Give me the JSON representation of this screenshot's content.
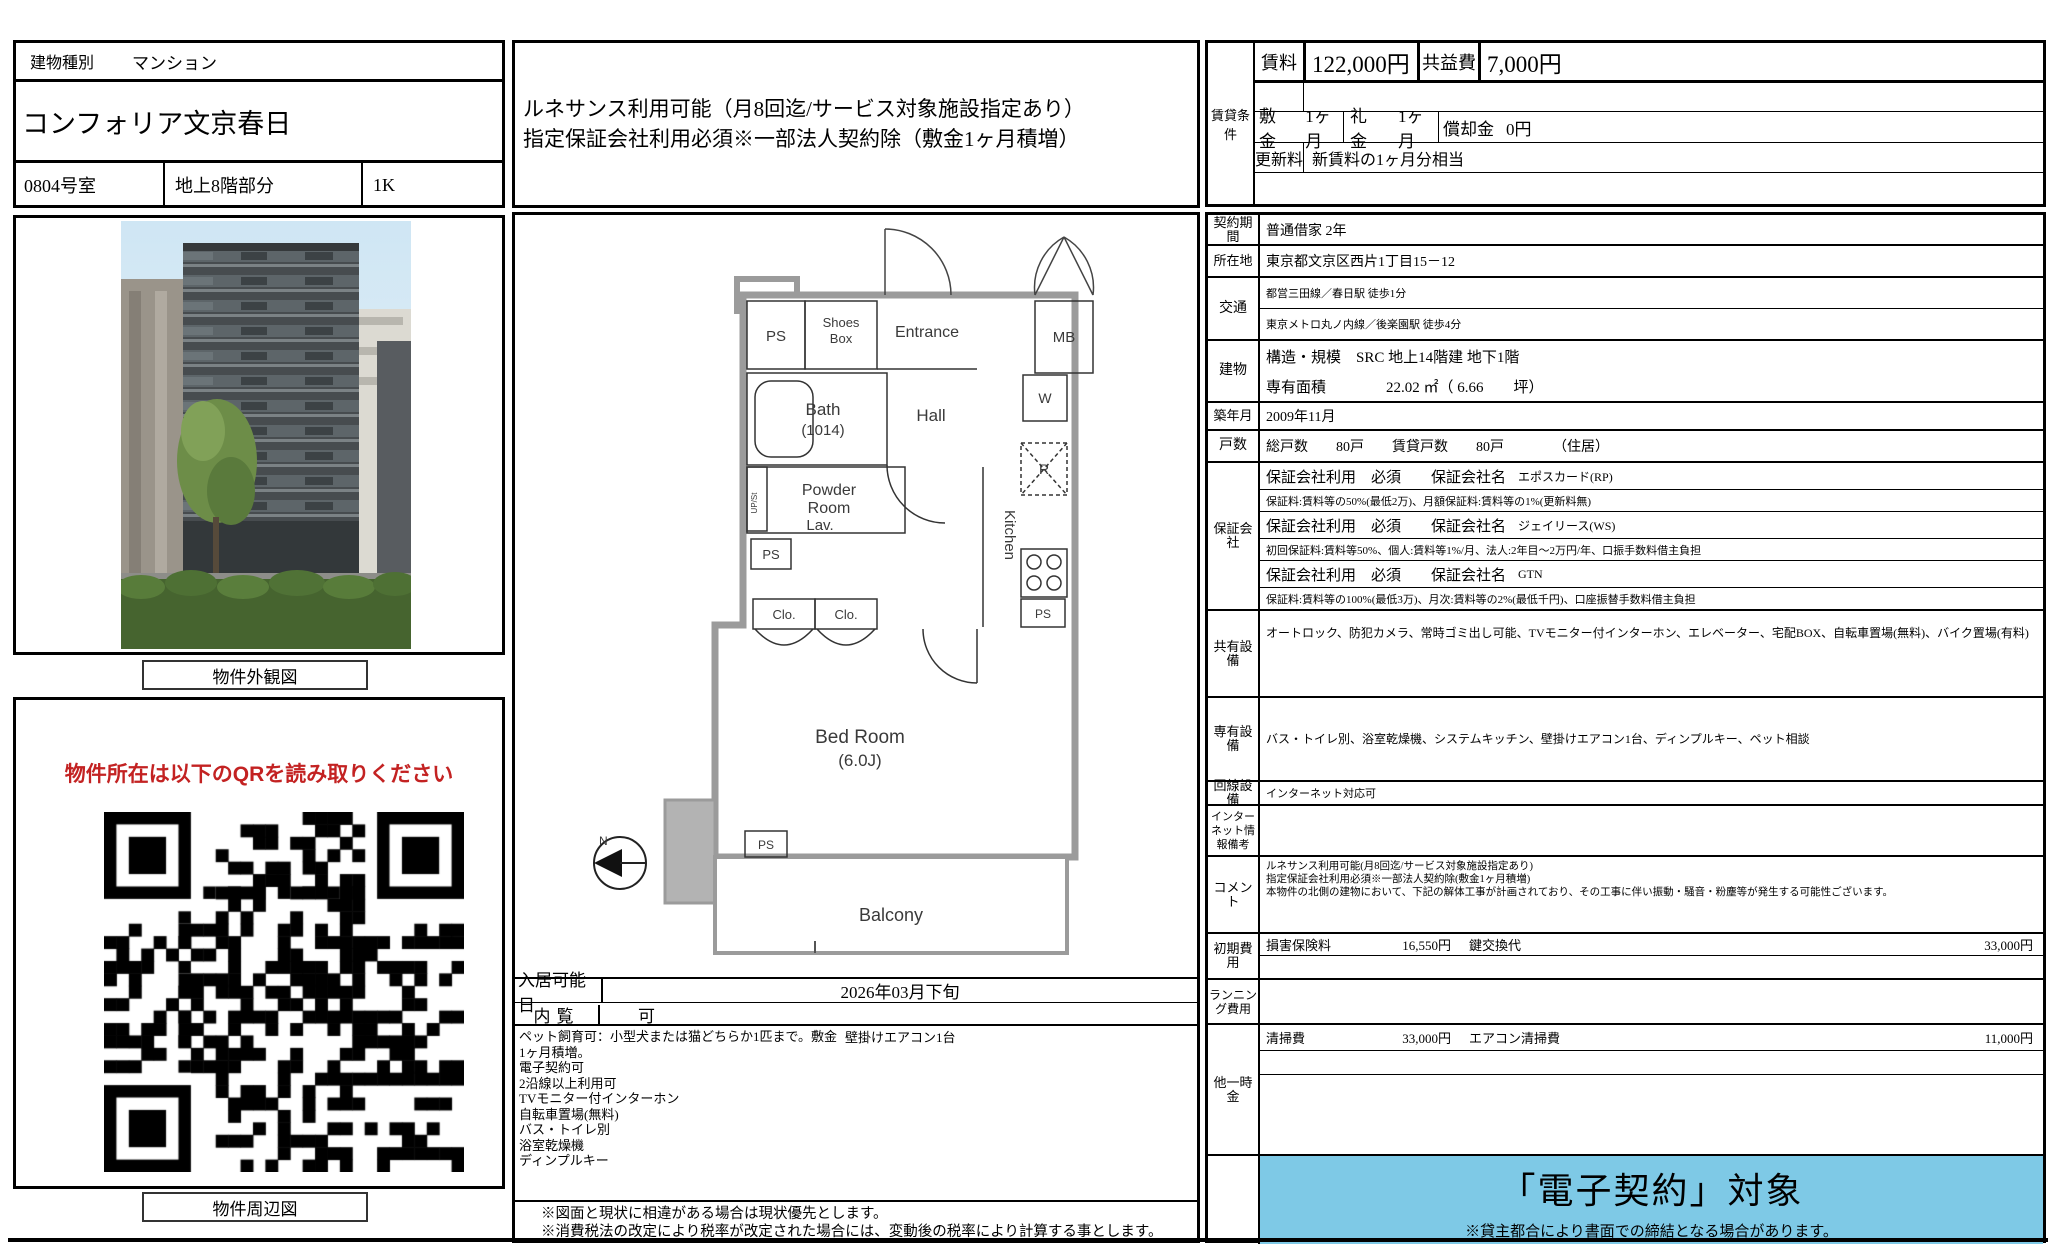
{
  "header": {
    "building_type_label": "建物種別",
    "building_type_value": "マンション",
    "property_name": "コンフォリア文京春日",
    "room_no": "0804号室",
    "floor": "地上8階部分",
    "layout": "1K"
  },
  "top_note": {
    "line1": "ルネサンス利用可能（月8回迄/サービス対象施設指定あり）",
    "line2": "指定保証会社利用必須※一部法人契約除（敷金1ヶ月積増）"
  },
  "photo": {
    "caption": "物件外観図"
  },
  "qr": {
    "heading": "物件所在は以下のQRを読み取りください",
    "heading_color": "#c32222",
    "caption": "物件周辺図"
  },
  "rent_box": {
    "group_label": "賃貸条件",
    "rent_label": "賃料",
    "rent_value": "122,000円",
    "fee_label": "共益費",
    "fee_value": "7,000円",
    "deposit_label": "敷金",
    "deposit_value": "1ヶ月",
    "key_label": "礼金",
    "key_value": "1ヶ月",
    "amort_label": "償却金",
    "amort_value": "0円",
    "renewal_label": "更新料",
    "renewal_value": "新賃料の1ヶ月分相当"
  },
  "details": {
    "contract": {
      "label": "契約期間",
      "value": "普通借家 2年"
    },
    "address": {
      "label": "所在地",
      "value": "東京都文京区西片1丁目15－12"
    },
    "access": {
      "label": "交通",
      "lines": [
        "都営三田線／春日駅 徒歩1分",
        "東京メトロ丸ノ内線／後楽園駅 徒歩4分"
      ]
    },
    "building": {
      "label": "建物",
      "structure": "構造・規模　SRC 地上14階建 地下1階",
      "area": "専有面積　　　　22.02 ㎡（ 6.66　　坪）"
    },
    "built": {
      "label": "築年月",
      "value": "2009年11月"
    },
    "units": {
      "label": "戸数",
      "value": "総戸数　　80戸　　賃貸戸数　　80戸　　　　（住居）"
    },
    "guarantor": {
      "label": "保証会社",
      "rows": [
        {
          "main": "保証会社利用　必須　　保証会社名",
          "name": "エポスカード(RP)"
        },
        {
          "sub": "保証料:賃料等の50%(最低2万)、月額保証料:賃料等の1%(更新料無)"
        },
        {
          "main": "保証会社利用　必須　　保証会社名",
          "name": "ジェイリース(WS)"
        },
        {
          "sub": "初回保証料:賃料等50%、個人:賃料等1%/月、法人:2年目～2万円/年、口振手数料借主負担"
        },
        {
          "main": "保証会社利用　必須　　保証会社名",
          "name": "GTN"
        },
        {
          "sub": "保証料:賃料等の100%(最低3万)、月次:賃料等の2%(最低千円)、口座振替手数料借主負担"
        }
      ]
    },
    "shared": {
      "label": "共有設備",
      "value": "オートロック、防犯カメラ、常時ゴミ出し可能、TVモニター付インターホン、エレベーター、宅配BOX、自転車置場(無料)、バイク置場(有料)"
    },
    "private": {
      "label": "専有設備",
      "value": "バス・トイレ別、浴室乾燥機、システムキッチン、壁掛けエアコン1台、ディンプルキー、ペット相談"
    },
    "line": {
      "label": "回線設備",
      "value": "インターネット対応可"
    },
    "internet": {
      "label": "インターネット情報備考",
      "value": ""
    },
    "comment": {
      "label": "コメント",
      "lines": [
        "ルネサンス利用可能(月8回迄/サービス対象施設指定あり)",
        "指定保証会社利用必須※一部法人契約除(敷金1ヶ月積増)",
        "本物件の北側の建物において、下記の解体工事が計画されており、その工事に伴い振動・騒音・粉塵等が発生する可能性ございます。"
      ]
    },
    "initial": {
      "label": "初期費用",
      "item1_label": "損害保険料",
      "item1_value": "16,550円",
      "item2_label": "鍵交換代",
      "item2_value": "33,000円"
    },
    "running": {
      "label": "ランニング費用"
    },
    "onetime": {
      "label": "他一時金",
      "item1_label": "清掃費",
      "item1_value": "33,000円",
      "item2_label": "エアコン清掃費",
      "item2_value": "11,000円"
    }
  },
  "floorplan": {
    "ps_top": "PS",
    "shoes1": "Shoes",
    "shoes2": "Box",
    "entrance": "Entrance",
    "mb": "MB",
    "bath1": "Bath",
    "bath2": "(1014)",
    "hall": "Hall",
    "w": "W",
    "r": "R",
    "powder1": "Powder",
    "powder2": "Room",
    "powder3": "Lav.",
    "upst": "UP/St",
    "ps2": "PS",
    "kitchen": "Kitchen",
    "ps3": "PS",
    "clo1": "Clo.",
    "clo2": "Clo.",
    "bedroom1": "Bed Room",
    "bedroom2": "(6.0J)",
    "ps4": "PS",
    "balcony": "Balcony",
    "north": "N"
  },
  "movein": {
    "label": "入居可能日",
    "value": "2026年03月下旬",
    "view_label": "内覧",
    "view_value": "可",
    "features": [
      "ペット飼育可：小型犬または猫どちらか1匹まで。敷金1ヶ月積増。",
      "電子契約可",
      "2沿線以上利用可",
      "TVモニター付インターホン",
      "自転車置場(無料)",
      "バス・トイレ別",
      "浴室乾燥機",
      "ディンプルキー"
    ],
    "feature_right": "壁掛けエアコン1台"
  },
  "footnotes": {
    "n1": "※図面と現状に相違がある場合は現状優先とします。",
    "n2": "※消費税法の改定により税率が改定された場合には、変動後の税率により計算する事とします。"
  },
  "econtract": {
    "title": "「電子契約」対象",
    "note": "※貸主都合により書面での締結となる場合があります。",
    "bg": "#7ec9e6"
  }
}
